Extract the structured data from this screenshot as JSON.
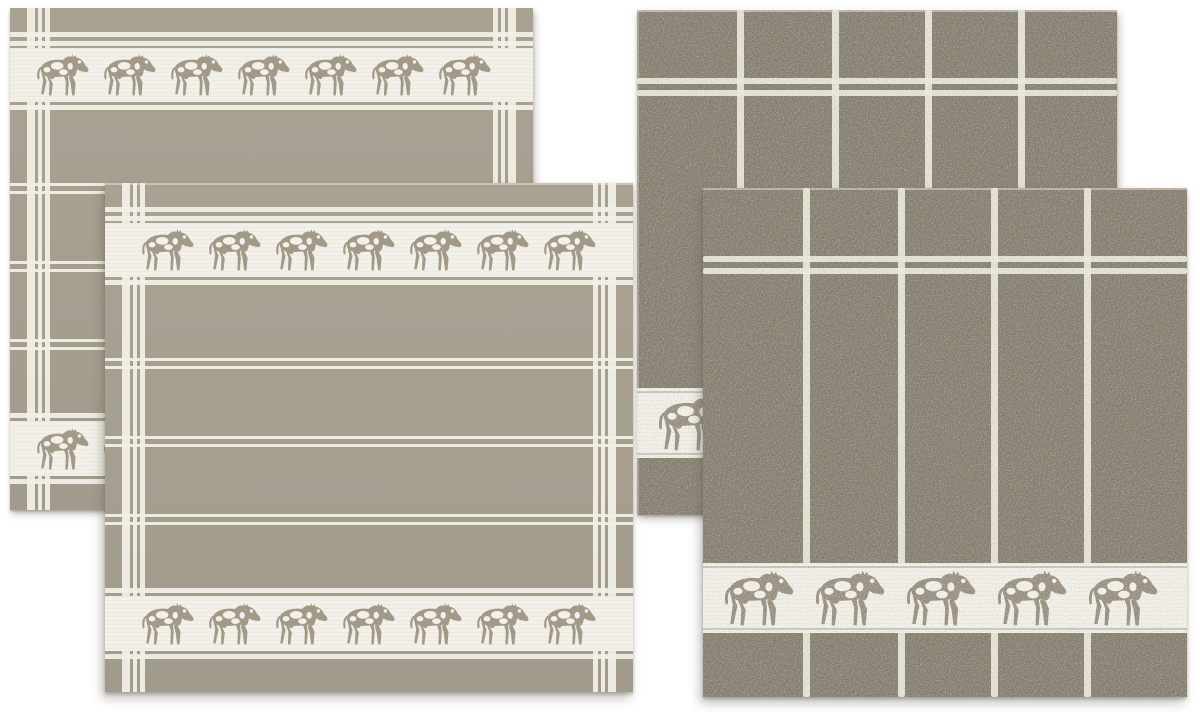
{
  "scene": {
    "kind": "product-photo",
    "alt": "Four-piece kitchen towel set in taupe and off-white with walking cow motif borders: two flat-woven checked tea towels on the left and two terry grid-striped kitchen towels on the right",
    "background_color": "#ffffff"
  },
  "palette": {
    "flat_base": "#a69f90",
    "flat_base_hi": "#a9a293",
    "flat_base_lo": "#a29b8c",
    "flat_cow": "#a29989",
    "terry_base": "#847d6e",
    "terry_cow": "#968d7f",
    "stripe_white": "#f1efe6",
    "terry_stripe_white": "#ebe9dc",
    "band_white": "#f2f0e8"
  },
  "towels": [
    {
      "key": "tea_towel_back",
      "label": "tea towel, back left",
      "fabric": "flat woven cotton",
      "pattern": "windowpane check with cow border bands",
      "cow_bands": [
        {
          "position": "top",
          "cow_count": 7
        },
        {
          "position": "bottom",
          "cow_count": 7
        }
      ]
    },
    {
      "key": "terry_towel_back",
      "label": "terry kitchen towel, back right",
      "fabric": "terry cotton",
      "pattern": "grid stripes with bottom cow border",
      "cow_bands": [
        {
          "position": "bottom",
          "cow_count": 5
        }
      ]
    },
    {
      "key": "tea_towel_front",
      "label": "tea towel, front left",
      "fabric": "flat woven cotton",
      "pattern": "windowpane check with cow border bands",
      "cow_bands": [
        {
          "position": "top",
          "cow_count": 7
        },
        {
          "position": "bottom",
          "cow_count": 7
        }
      ]
    },
    {
      "key": "terry_towel_front",
      "label": "terry kitchen towel, front right",
      "fabric": "terry cotton",
      "pattern": "grid stripes with bottom cow border",
      "cow_bands": [
        {
          "position": "bottom",
          "cow_count": 5
        }
      ]
    }
  ]
}
